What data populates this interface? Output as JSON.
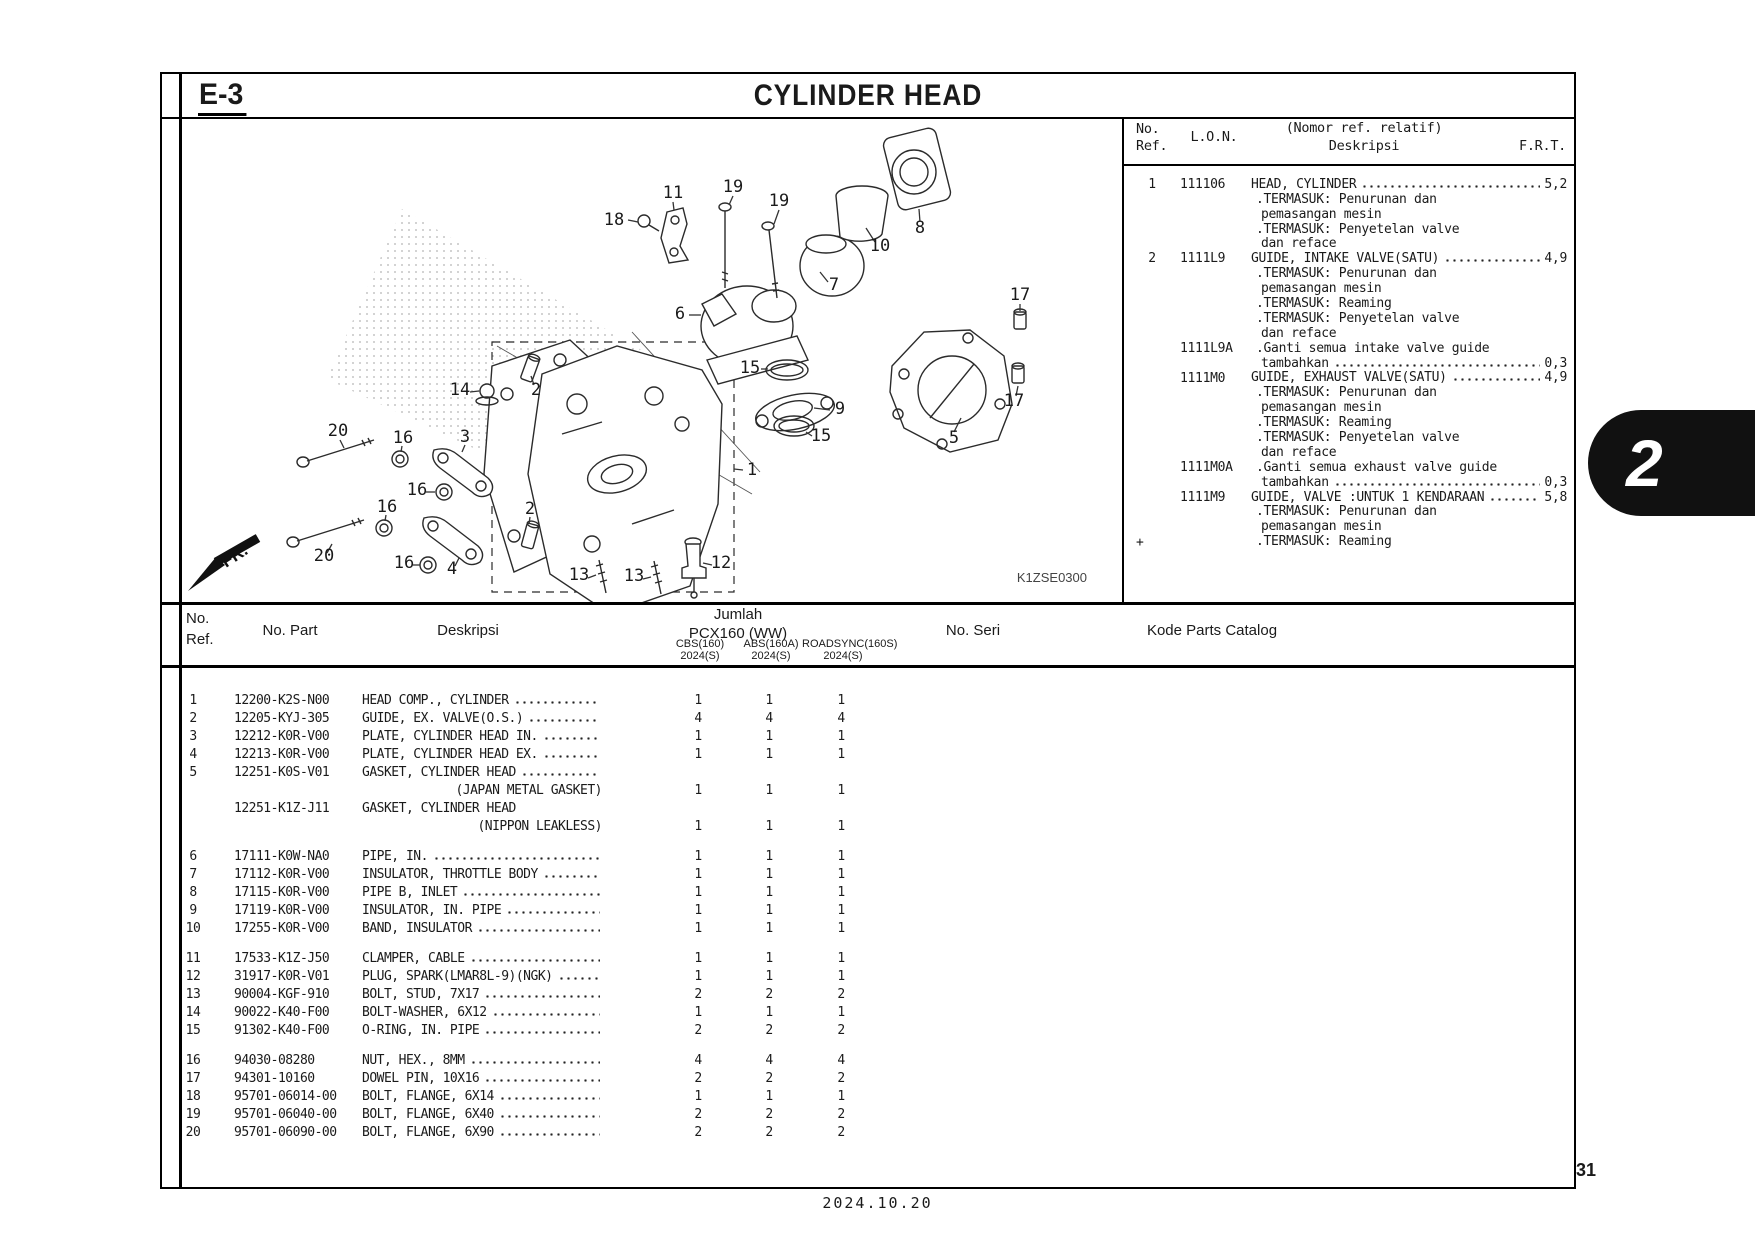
{
  "colors": {
    "ink": "#1a1a1a",
    "line": "#000000",
    "tab_bg": "#111111",
    "paper": "#ffffff"
  },
  "page": {
    "section_code": "E-3",
    "title": "CYLINDER HEAD",
    "page_number": "31",
    "date": "2024.10.20",
    "tab": "2"
  },
  "diagram": {
    "code": "K1ZSE0300",
    "fr": "FR.",
    "callouts": [
      {
        "n": "18",
        "x": 452,
        "y": 151,
        "l": [
          466,
          146,
          476,
          148
        ]
      },
      {
        "n": "11",
        "x": 511,
        "y": 124,
        "l": [
          511,
          128,
          512,
          136
        ]
      },
      {
        "n": "19",
        "x": 571,
        "y": 118,
        "l": [
          571,
          122,
          567,
          131
        ]
      },
      {
        "n": "19",
        "x": 617,
        "y": 132,
        "l": [
          617,
          136,
          612,
          150
        ]
      },
      {
        "n": "10",
        "x": 718,
        "y": 177,
        "l": [
          713,
          168,
          704,
          154
        ]
      },
      {
        "n": "8",
        "x": 758,
        "y": 159,
        "l": [
          758,
          148,
          757,
          135
        ]
      },
      {
        "n": "7",
        "x": 672,
        "y": 216,
        "l": [
          666,
          208,
          658,
          198
        ]
      },
      {
        "n": "6",
        "x": 518,
        "y": 245,
        "l": [
          527,
          241,
          539,
          241
        ]
      },
      {
        "n": "15",
        "x": 588,
        "y": 299,
        "l": [
          599,
          295,
          606,
          295
        ]
      },
      {
        "n": "9",
        "x": 678,
        "y": 340,
        "l": [
          668,
          336,
          652,
          334
        ]
      },
      {
        "n": "15",
        "x": 659,
        "y": 367,
        "l": [
          650,
          362,
          644,
          358
        ]
      },
      {
        "n": "1",
        "x": 590,
        "y": 401,
        "l": [
          581,
          396,
          572,
          395
        ]
      },
      {
        "n": "17",
        "x": 858,
        "y": 226,
        "l": [
          858,
          230,
          858,
          237
        ]
      },
      {
        "n": "17",
        "x": 852,
        "y": 332,
        "l": [
          854,
          322,
          856,
          312
        ]
      },
      {
        "n": "5",
        "x": 792,
        "y": 369,
        "l": [
          792,
          358,
          799,
          344
        ]
      },
      {
        "n": "2",
        "x": 374,
        "y": 321,
        "l": [
          372,
          311,
          369,
          302
        ]
      },
      {
        "n": "14",
        "x": 298,
        "y": 321,
        "l": [
          308,
          318,
          317,
          317
        ]
      },
      {
        "n": "20",
        "x": 176,
        "y": 362,
        "l": [
          178,
          366,
          182,
          374
        ]
      },
      {
        "n": "16",
        "x": 241,
        "y": 369,
        "l": [
          240,
          372,
          239,
          378
        ]
      },
      {
        "n": "3",
        "x": 303,
        "y": 368,
        "l": [
          303,
          371,
          300,
          378
        ]
      },
      {
        "n": "16",
        "x": 255,
        "y": 421,
        "l": [
          264,
          418,
          273,
          418
        ]
      },
      {
        "n": "16",
        "x": 225,
        "y": 438,
        "l": [
          224,
          441,
          223,
          447
        ]
      },
      {
        "n": "2",
        "x": 368,
        "y": 440,
        "l": [
          368,
          443,
          367,
          450
        ]
      },
      {
        "n": "20",
        "x": 162,
        "y": 487,
        "l": [
          165,
          479,
          170,
          470
        ]
      },
      {
        "n": "16",
        "x": 242,
        "y": 494,
        "l": [
          251,
          491,
          258,
          491
        ]
      },
      {
        "n": "4",
        "x": 290,
        "y": 500,
        "l": [
          293,
          492,
          297,
          484
        ]
      },
      {
        "n": "13",
        "x": 417,
        "y": 506,
        "l": [
          426,
          504,
          434,
          501
        ]
      },
      {
        "n": "13",
        "x": 472,
        "y": 507,
        "l": [
          481,
          505,
          489,
          503
        ]
      },
      {
        "n": "12",
        "x": 559,
        "y": 494,
        "l": [
          550,
          491,
          541,
          489
        ]
      }
    ]
  },
  "panel": {
    "headers": {
      "ref_l1": "No.",
      "ref_l2": "Ref.",
      "lon": "L.O.N.",
      "desc_l1": "(Nomor ref. relatif)",
      "desc_l2": "Deskripsi",
      "frt": "F.R.T."
    },
    "footnote_mark": "+",
    "entries": [
      {
        "ref": "1",
        "lon": "111106",
        "lines": [
          {
            "t": "HEAD, CYLINDER",
            "f": "5,2"
          },
          {
            "t": ".TERMASUK: Penurunan dan",
            "i": 1
          },
          {
            "t": "pemasangan mesin",
            "i": 2
          },
          {
            "t": ".TERMASUK: Penyetelan valve",
            "i": 1
          },
          {
            "t": "dan reface",
            "i": 2
          }
        ]
      },
      {
        "ref": "2",
        "lon": "1111L9",
        "lines": [
          {
            "t": "GUIDE, INTAKE VALVE(SATU)",
            "f": "4,9"
          },
          {
            "t": ".TERMASUK: Penurunan dan",
            "i": 1
          },
          {
            "t": "pemasangan mesin",
            "i": 2
          },
          {
            "t": ".TERMASUK: Reaming",
            "i": 1
          },
          {
            "t": ".TERMASUK: Penyetelan valve",
            "i": 1
          },
          {
            "t": "dan reface",
            "i": 2
          }
        ]
      },
      {
        "ref": "",
        "lon": "1111L9A",
        "lines": [
          {
            "t": ".Ganti semua intake valve guide",
            "i": 1
          },
          {
            "t": "tambahkan",
            "i": 2,
            "f": "0,3"
          }
        ]
      },
      {
        "ref": "",
        "lon": "1111M0",
        "lines": [
          {
            "t": "GUIDE, EXHAUST VALVE(SATU)",
            "f": "4,9"
          },
          {
            "t": ".TERMASUK: Penurunan dan",
            "i": 1
          },
          {
            "t": "pemasangan mesin",
            "i": 2
          },
          {
            "t": ".TERMASUK: Reaming",
            "i": 1
          },
          {
            "t": ".TERMASUK: Penyetelan valve",
            "i": 1
          },
          {
            "t": "dan reface",
            "i": 2
          }
        ]
      },
      {
        "ref": "",
        "lon": "1111M0A",
        "lines": [
          {
            "t": ".Ganti semua exhaust valve guide",
            "i": 1
          },
          {
            "t": "tambahkan",
            "i": 2,
            "f": "0,3"
          }
        ]
      },
      {
        "ref": "",
        "lon": "1111M9",
        "lines": [
          {
            "t": "GUIDE, VALVE :UNTUK 1 KENDARAAN",
            "f": "5,8"
          },
          {
            "t": ".TERMASUK: Penurunan dan",
            "i": 1
          },
          {
            "t": "pemasangan mesin",
            "i": 2
          },
          {
            "t": ".TERMASUK: Reaming",
            "i": 1
          }
        ]
      }
    ]
  },
  "table": {
    "headers": {
      "ref_l1": "No.",
      "ref_l2": "Ref.",
      "part": "No. Part",
      "desc": "Deskripsi",
      "jumlah": "Jumlah",
      "model": "PCX160 (WW)",
      "cols": [
        {
          "l1": "CBS(160)",
          "l2": "2024(S)"
        },
        {
          "l1": "ABS(160A)",
          "l2": "2024(S)"
        },
        {
          "l1": "ROADSYNC(160S)",
          "l2": "2024(S)"
        }
      ],
      "seri": "No. Seri",
      "kode": "Kode Parts Catalog"
    },
    "rows": [
      {
        "ref": "1",
        "part": "12200-K2S-N00",
        "desc": "HEAD COMP., CYLINDER",
        "dots": true,
        "qty": [
          "1",
          "1",
          "1"
        ]
      },
      {
        "ref": "2",
        "part": "12205-KYJ-305",
        "desc": "GUIDE, EX. VALVE(O.S.)",
        "dots": true,
        "qty": [
          "4",
          "4",
          "4"
        ]
      },
      {
        "ref": "3",
        "part": "12212-K0R-V00",
        "desc": "PLATE, CYLINDER HEAD IN.",
        "dots": true,
        "qty": [
          "1",
          "1",
          "1"
        ]
      },
      {
        "ref": "4",
        "part": "12213-K0R-V00",
        "desc": "PLATE, CYLINDER HEAD EX.",
        "dots": true,
        "qty": [
          "1",
          "1",
          "1"
        ]
      },
      {
        "ref": "5",
        "part": "12251-K0S-V01",
        "desc": "GASKET, CYLINDER HEAD",
        "dots": true,
        "sub": "(JAPAN METAL GASKET)",
        "qty": [
          "1",
          "1",
          "1"
        ]
      },
      {
        "ref": "",
        "part": "12251-K1Z-J11",
        "desc": "GASKET, CYLINDER HEAD",
        "dots": false,
        "sub": "(NIPPON LEAKLESS)",
        "qty": [
          "1",
          "1",
          "1"
        ]
      },
      {
        "ref": "6",
        "part": "17111-K0W-NA0",
        "desc": "PIPE, IN.",
        "dots": true,
        "qty": [
          "1",
          "1",
          "1"
        ],
        "gap": true
      },
      {
        "ref": "7",
        "part": "17112-K0R-V00",
        "desc": "INSULATOR, THROTTLE BODY",
        "dots": true,
        "qty": [
          "1",
          "1",
          "1"
        ]
      },
      {
        "ref": "8",
        "part": "17115-K0R-V00",
        "desc": "PIPE B, INLET",
        "dots": true,
        "qty": [
          "1",
          "1",
          "1"
        ]
      },
      {
        "ref": "9",
        "part": "17119-K0R-V00",
        "desc": "INSULATOR, IN. PIPE",
        "dots": true,
        "qty": [
          "1",
          "1",
          "1"
        ]
      },
      {
        "ref": "10",
        "part": "17255-K0R-V00",
        "desc": "BAND, INSULATOR",
        "dots": true,
        "qty": [
          "1",
          "1",
          "1"
        ]
      },
      {
        "ref": "11",
        "part": "17533-K1Z-J50",
        "desc": "CLAMPER, CABLE",
        "dots": true,
        "qty": [
          "1",
          "1",
          "1"
        ],
        "gap": true
      },
      {
        "ref": "12",
        "part": "31917-K0R-V01",
        "desc": "PLUG, SPARK(LMAR8L-9)(NGK)",
        "dots": true,
        "qty": [
          "1",
          "1",
          "1"
        ]
      },
      {
        "ref": "13",
        "part": "90004-KGF-910",
        "desc": "BOLT, STUD, 7X17",
        "dots": true,
        "qty": [
          "2",
          "2",
          "2"
        ]
      },
      {
        "ref": "14",
        "part": "90022-K40-F00",
        "desc": "BOLT-WASHER, 6X12",
        "dots": true,
        "qty": [
          "1",
          "1",
          "1"
        ]
      },
      {
        "ref": "15",
        "part": "91302-K40-F00",
        "desc": "O-RING, IN. PIPE",
        "dots": true,
        "qty": [
          "2",
          "2",
          "2"
        ]
      },
      {
        "ref": "16",
        "part": "94030-08280",
        "desc": "NUT, HEX., 8MM",
        "dots": true,
        "qty": [
          "4",
          "4",
          "4"
        ],
        "gap": true
      },
      {
        "ref": "17",
        "part": "94301-10160",
        "desc": "DOWEL PIN, 10X16",
        "dots": true,
        "qty": [
          "2",
          "2",
          "2"
        ]
      },
      {
        "ref": "18",
        "part": "95701-06014-00",
        "desc": "BOLT, FLANGE, 6X14",
        "dots": true,
        "qty": [
          "1",
          "1",
          "1"
        ]
      },
      {
        "ref": "19",
        "part": "95701-06040-00",
        "desc": "BOLT, FLANGE, 6X40",
        "dots": true,
        "qty": [
          "2",
          "2",
          "2"
        ]
      },
      {
        "ref": "20",
        "part": "95701-06090-00",
        "desc": "BOLT, FLANGE, 6X90",
        "dots": true,
        "qty": [
          "2",
          "2",
          "2"
        ]
      }
    ]
  }
}
